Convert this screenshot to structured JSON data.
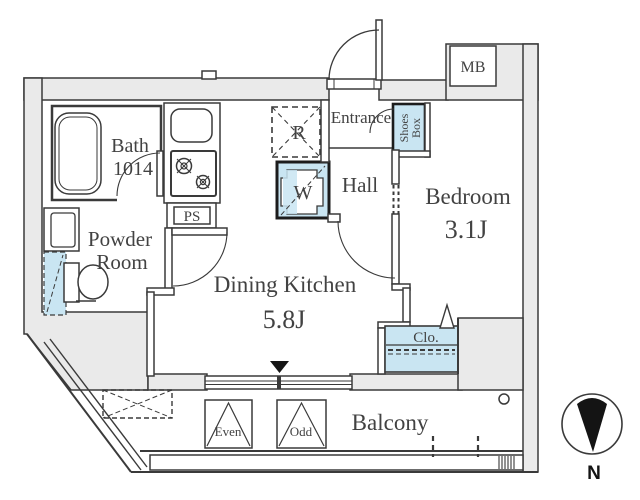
{
  "floorplan": {
    "rooms": {
      "bath": {
        "name": "Bath",
        "size": "1014"
      },
      "powder_room": {
        "line1": "Powder",
        "line2": "Room"
      },
      "dining_kitchen": {
        "name": "Dining Kitchen",
        "size": "5.8J"
      },
      "hall": {
        "name": "Hall"
      },
      "entrance": {
        "name": "Entrance"
      },
      "bedroom": {
        "name": "Bedroom",
        "size": "3.1J"
      },
      "balcony": {
        "name": "Balcony"
      }
    },
    "fixtures": {
      "pipe_space": "PS",
      "meter_box": "MB",
      "closet": "Clo.",
      "shoes_box": {
        "line1": "Shoes",
        "line2": "Box"
      },
      "refrigerator_mark": "R",
      "washer_mark": "W",
      "window_panel_even": "Even",
      "window_panel_odd": "Odd"
    },
    "compass": {
      "north": "N"
    },
    "colors": {
      "wall_fill": "#eaeaea",
      "fixture_blue": "#c9e5f2",
      "line": "#3a3a3a",
      "text": "#424242"
    }
  }
}
